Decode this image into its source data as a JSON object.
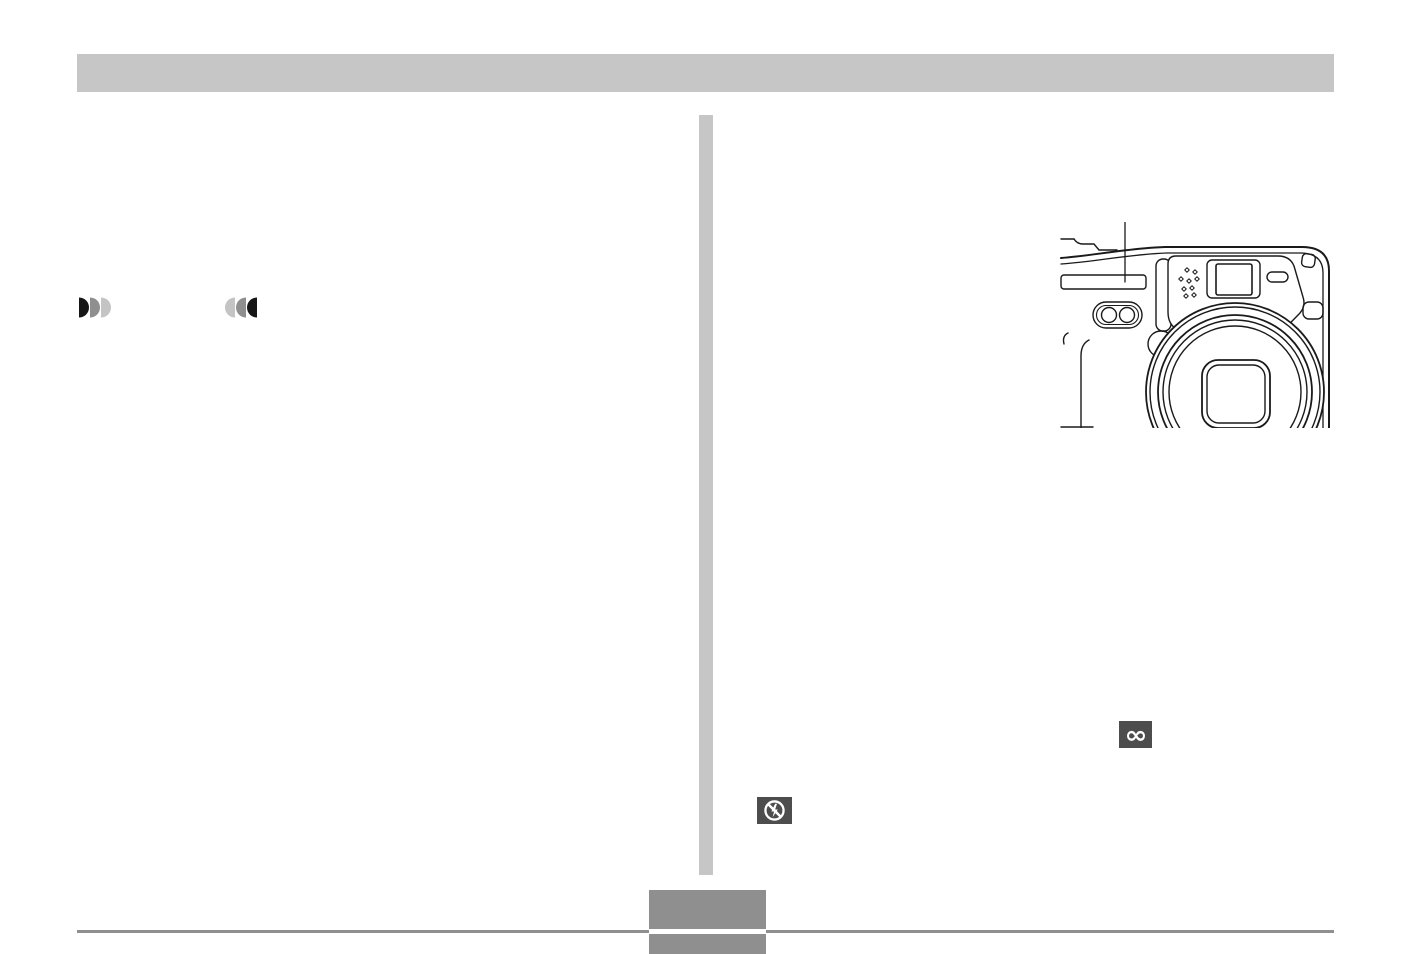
{
  "document": {
    "type": "camera-manual-page",
    "background": "#ffffff",
    "visible_text": ""
  },
  "header": {
    "bar_color": "#c6c6c6"
  },
  "divider": {
    "color": "#c6c6c6"
  },
  "left_column": {
    "telephoto_zoom_icon": {
      "name": "telephoto-zoom-indicator",
      "segment_colors": [
        "#161616",
        "#8f8f8f",
        "#c4c4c4"
      ]
    },
    "wide_angle_zoom_icon": {
      "name": "wide-angle-zoom-indicator",
      "segment_colors": [
        "#c4c4c4",
        "#8f8f8f",
        "#161616"
      ]
    }
  },
  "right_column": {
    "camera_illustration": {
      "name": "camera-front-line-art",
      "stroke_color": "#1a1a1a",
      "features": [
        "callout-line",
        "flash-window",
        "lamp-capsule",
        "microphone-holes",
        "viewfinder-window",
        "light-sensor",
        "lens-rings",
        "lens-aperture",
        "strap-lug"
      ]
    },
    "infinity_icon": {
      "glyph": "∞",
      "background": "#4d4d4d",
      "color": "#ffffff"
    },
    "flash_off_icon": {
      "name": "flash-off-indicator",
      "background": "#4d4d4d",
      "color": "#ffffff"
    }
  },
  "footer": {
    "rule_color": "#8f8f8f",
    "page_number_box_color": "#8f8f8f"
  }
}
